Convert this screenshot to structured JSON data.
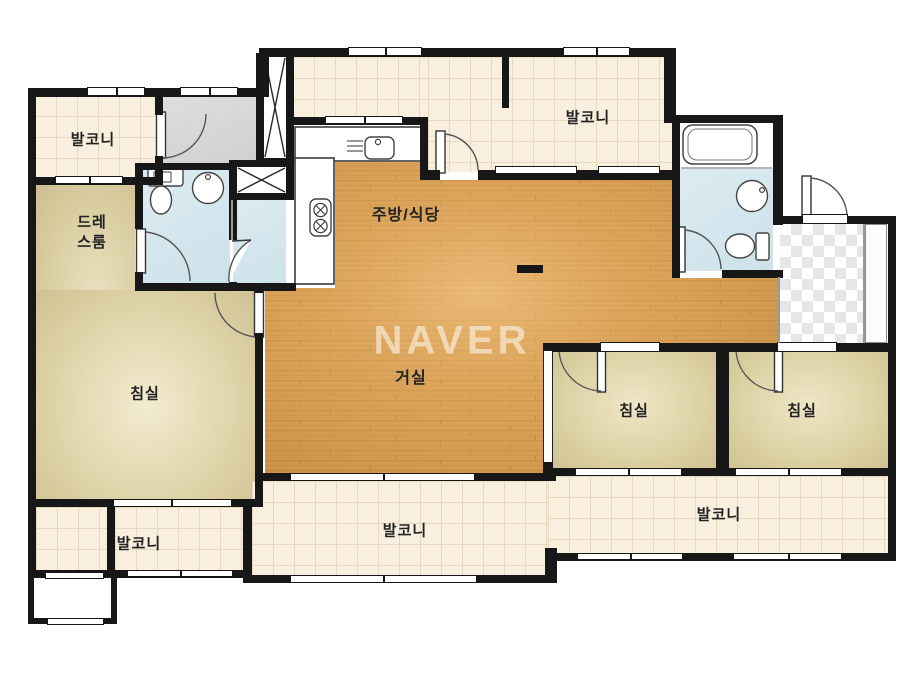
{
  "watermark": "NAVER",
  "rooms": {
    "balcony_top_left": {
      "label": "발코니"
    },
    "balcony_top_center": {
      "label": "발코니"
    },
    "dress_room": {
      "line1": "드레",
      "line2": "스룸"
    },
    "kitchen_dining": {
      "label": "주방/식당"
    },
    "living_room": {
      "label": "거실"
    },
    "bedroom_master": {
      "label": "침실"
    },
    "bedroom_2": {
      "label": "침실"
    },
    "bedroom_3": {
      "label": "침실"
    },
    "balcony_bottom_left": {
      "label": "발코니"
    },
    "balcony_bottom_center": {
      "label": "발코니"
    },
    "balcony_bottom_right": {
      "label": "발코니"
    }
  },
  "colors": {
    "wall": "#171717",
    "wood_floor": "#d69c52",
    "bedroom_floor": "#e0d5ab",
    "balcony_tile": "#f8efdf",
    "bathroom": "#d5e7ee",
    "utility_gray": "#d6d7d8"
  }
}
